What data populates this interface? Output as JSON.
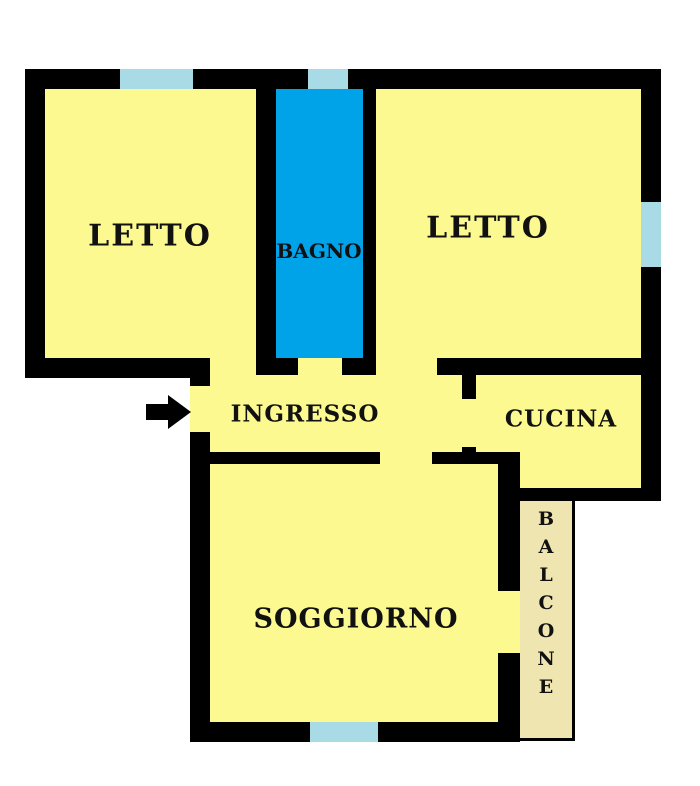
{
  "plan": {
    "type": "apartment-floor-plan"
  },
  "colors": {
    "room": "#FBF98F",
    "bathroom": "#00A2E8",
    "window": "#A9DBE6",
    "balcony": "#EFE5B0",
    "wall": "#000000",
    "background": "#FFFFFF",
    "label": "#111111"
  },
  "rooms": {
    "letto_left": "LETTO",
    "bagno": "BAGNO",
    "letto_right": "LETTO",
    "ingresso": "INGRESSO",
    "cucina": "CUCINA",
    "soggiorno": "SOGGIORNO",
    "balcone": "BALCONE"
  }
}
